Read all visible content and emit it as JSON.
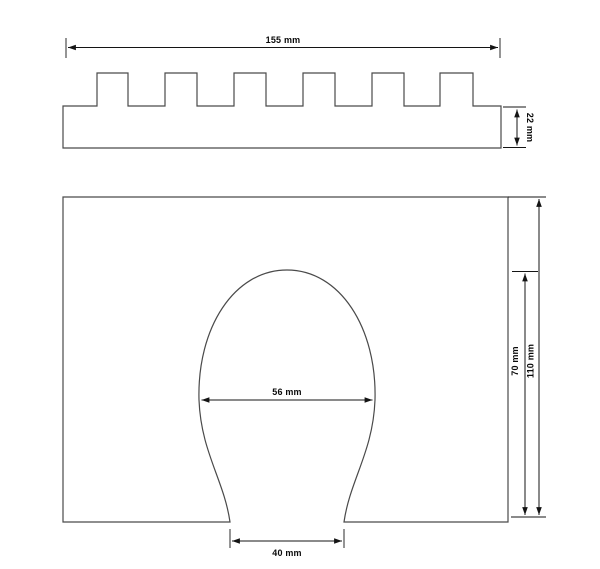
{
  "page": {
    "background_color": "#ffffff",
    "line_color": "#4a4a4a",
    "dimension_color": "#141414"
  },
  "views": {
    "comb_profile": {
      "description": "top comb profile view with six teeth",
      "dimensions": {
        "overall_width": "155 mm",
        "base_height": "22 mm"
      }
    },
    "plate_with_cutout": {
      "description": "front plate view with horseshoe shaped cutout",
      "dimensions": {
        "cutout_max_width": "56 mm",
        "opening_width": "40 mm",
        "cutout_height": "70 mm",
        "overall_height": "110 mm"
      }
    }
  }
}
